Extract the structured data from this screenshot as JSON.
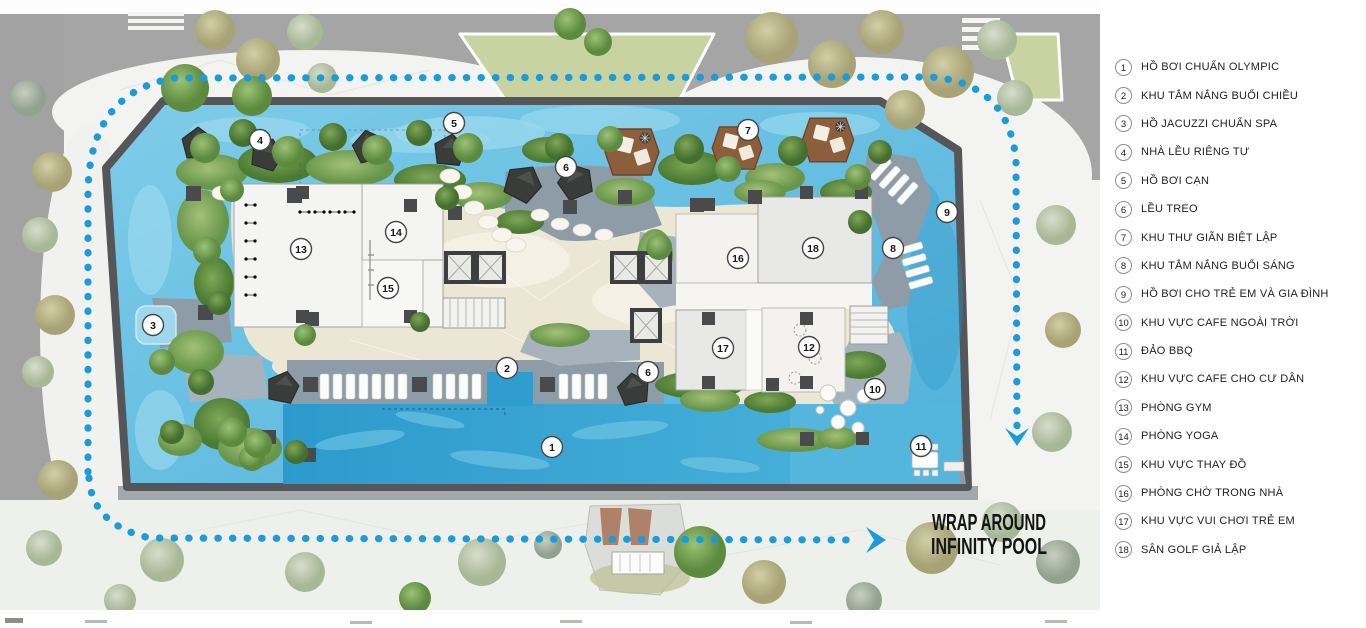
{
  "legend": {
    "items": [
      {
        "num": "1",
        "label": "HỒ BƠI CHUẨN OLYMPIC"
      },
      {
        "num": "2",
        "label": "KHU TẮM NẮNG BUỔI CHIỀU"
      },
      {
        "num": "3",
        "label": "HỒ JACUZZI CHUẨN SPA"
      },
      {
        "num": "4",
        "label": "NHÀ LỀU RIÊNG TƯ"
      },
      {
        "num": "5",
        "label": "HỒ BƠI CẠN"
      },
      {
        "num": "6",
        "label": "LỀU TREO"
      },
      {
        "num": "7",
        "label": "KHU THƯ GIÃN BIỆT LẬP"
      },
      {
        "num": "8",
        "label": "KHU TẮM NẮNG BUỔI SÁNG"
      },
      {
        "num": "9",
        "label": "HỒ BƠI CHO TRẺ EM VÀ GIA ĐÌNH"
      },
      {
        "num": "10",
        "label": "KHU VỰC CAFE NGOÀI TRỜI"
      },
      {
        "num": "11",
        "label": "ĐẢO BBQ"
      },
      {
        "num": "12",
        "label": "KHU VỰC CAFE CHO CƯ DÂN"
      },
      {
        "num": "13",
        "label": "PHÒNG GYM"
      },
      {
        "num": "14",
        "label": "PHÒNG YOGA"
      },
      {
        "num": "15",
        "label": "KHU VỰC THAY ĐỒ"
      },
      {
        "num": "16",
        "label": "PHÒNG CHỜ TRONG NHÀ"
      },
      {
        "num": "17",
        "label": "KHU VỰC VUI CHƠI TRẺ EM"
      },
      {
        "num": "18",
        "label": "SÂN GOLF GIẢ LẬP"
      }
    ]
  },
  "plan": {
    "annotation": {
      "line1": "WRAP AROUND",
      "line2": "INFINITY POOL"
    },
    "markers": [
      {
        "n": "1",
        "x": 552,
        "y": 447
      },
      {
        "n": "2",
        "x": 507,
        "y": 368
      },
      {
        "n": "3",
        "x": 153,
        "y": 325
      },
      {
        "n": "4",
        "x": 260,
        "y": 140
      },
      {
        "n": "5",
        "x": 454,
        "y": 123
      },
      {
        "n": "6",
        "x": 566,
        "y": 167
      },
      {
        "n": "6",
        "x": 648,
        "y": 372
      },
      {
        "n": "7",
        "x": 748,
        "y": 130
      },
      {
        "n": "8",
        "x": 893,
        "y": 248
      },
      {
        "n": "9",
        "x": 947,
        "y": 212
      },
      {
        "n": "10",
        "x": 875,
        "y": 389
      },
      {
        "n": "11",
        "x": 921,
        "y": 446
      },
      {
        "n": "12",
        "x": 809,
        "y": 347
      },
      {
        "n": "13",
        "x": 301,
        "y": 249
      },
      {
        "n": "14",
        "x": 396,
        "y": 232
      },
      {
        "n": "15",
        "x": 388,
        "y": 288
      },
      {
        "n": "16",
        "x": 738,
        "y": 258
      },
      {
        "n": "17",
        "x": 723,
        "y": 348
      },
      {
        "n": "18",
        "x": 813,
        "y": 248
      }
    ],
    "colors": {
      "path_blue": "#1b9cd8",
      "water": "#62bfe2",
      "pool": "#2f9dd0",
      "sand": "#ece6d4",
      "slate": "#8e9ca7",
      "vegetation": "#79a24f",
      "wood": "#8d5e3c",
      "street": "#a4a5a4",
      "lawn": "#c9d3a2",
      "marker_border": "#454545"
    }
  }
}
